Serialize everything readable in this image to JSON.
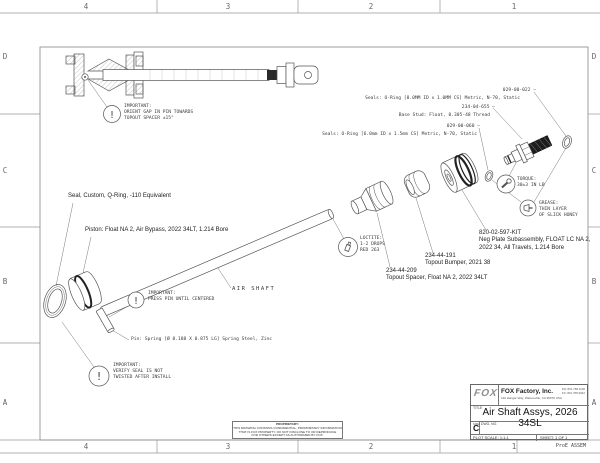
{
  "colors": {
    "line": "#555555",
    "frame": "#999999",
    "hatch": "#8a8a8a",
    "dark_fill": "#1d1d1d",
    "text": "#3a3a3a"
  },
  "zones": {
    "cols": [
      "4",
      "3",
      "2",
      "1"
    ],
    "rows": [
      "D",
      "C",
      "B",
      "A"
    ]
  },
  "icons": {
    "important": "!"
  },
  "notes": {
    "orient": [
      "IMPORTANT:",
      "ORIENT GAP IN PIN TOWARDS",
      "TOPOUT SPACER ±15°"
    ],
    "press_pin": [
      "IMPORTANT:",
      "PRESS PIN UNTIL CENTERED"
    ],
    "verify_seal": [
      "IMPORTANT:",
      "VERIFY SEAL IS NOT",
      "TWISTED AFTER INSTALL"
    ],
    "loctite": [
      "LOCTITE:",
      "1-2 DROPS",
      "RED 263"
    ],
    "torque": [
      "TORQUE:",
      "30±3 IN LB"
    ],
    "grease": [
      "GREASE:",
      "THIN LAYER",
      "OF SLICK HONEY"
    ]
  },
  "callouts": {
    "seals_8mm": "Seals: O-Ring [8.0MM ID x 1.0MM CS] Metric, N-70, Static",
    "pn_022": "029-00-022 —",
    "pn_655": "234-04-655 —",
    "base_stud": "Base Stud: Float, 0.305-48 Thread",
    "pn_060": "029-00-060 —",
    "seals_6mm": "Seals: O-Ring [6.0mm ID x 1.5mm CS] Metric, N-70, Static",
    "seal_custom": "Seal, Custom, Q-Ring, -110 Equivalent",
    "piston": "Piston: Float NA 2, Air Bypass, 2022 34LT, 1.214 Bore",
    "air_shaft": "AIR SHAFT",
    "pin": "Pin: Spring [Ø 0.188 X 0.875 LG] Spring Steel, Zinc",
    "kit_pn": "820-02-597-KIT",
    "kit_desc1": "Neg Plate Subassembly, FLOAT LC NA 2,",
    "kit_desc2": "2022 34, All Travels, 1.214 Bore",
    "bumper_pn": "234-44-191",
    "bumper_desc": "Topout Bumper, 2021 38",
    "spacer_pn": "234-44-209",
    "spacer_desc": "Topout Spacer, Float NA 2, 2022 34LT"
  },
  "title_block": {
    "logo": "FOX",
    "company": "FOX Factory, Inc.",
    "address": "130 Hangar Way, Watsonville, CA 95076 USA",
    "phone1": "PH: 831.768.1100",
    "phone2": "FX: 831.768.9342",
    "title_label": "TITLE",
    "title": "Air Shaft Assys, 2026 34SL",
    "size_label": "SIZE",
    "size": "C",
    "dwg_label": "DWG. NO.",
    "plot_scale": "PLOT SCALE: 1:1:1",
    "sheet": "SHEET: 1 OF 1",
    "footer": "ProE ASSEM"
  },
  "proprietary": {
    "heading": "PROPRIETARY:",
    "line1": "THIS DRAWING CONTAINS CONFIDENTIAL, PROPRIETARY INFORMATION",
    "line2": "THAT IS FOX PROPERTY. DO NOT DISCLOSE TO OR REPRODUCE",
    "line3": "FOR OTHERS EXCEPT AS AUTHORIZED BY FOX."
  }
}
